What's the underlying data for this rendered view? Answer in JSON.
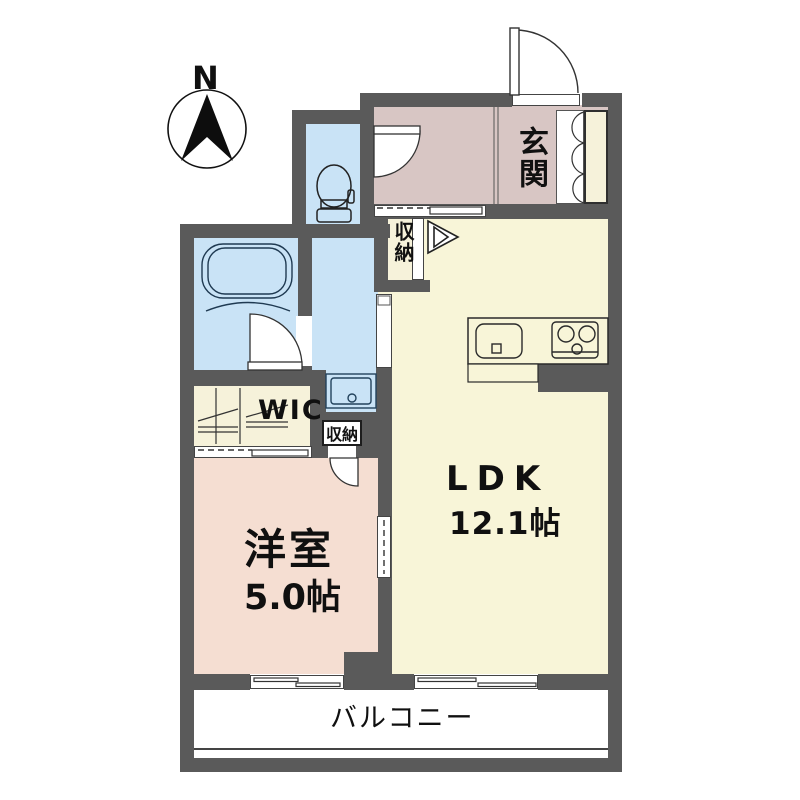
{
  "plan_title": "apartment-floor-plan",
  "compass": {
    "north_label": "N"
  },
  "rooms": {
    "entrance": {
      "label": "玄関"
    },
    "ldk": {
      "label": "LDK",
      "area": "12.1帖"
    },
    "western_room": {
      "label": "洋室",
      "area": "5.0帖"
    },
    "walk_in_closet": {
      "label": "WIC"
    },
    "hall_storage": {
      "label": "収納"
    },
    "room_storage": {
      "label": "収納"
    },
    "balcony": {
      "label": "バルコニー"
    }
  },
  "colors": {
    "wall": "#5a5a5a",
    "entrance_floor": "#d8c6c4",
    "ldk_floor": "#f8f5d8",
    "western_room_floor": "#f5ded2",
    "wet_area_floor": "#c9e3f6",
    "closet_floor": "#f6f2da",
    "outline": "#2a2a2a",
    "background": "#ffffff"
  }
}
